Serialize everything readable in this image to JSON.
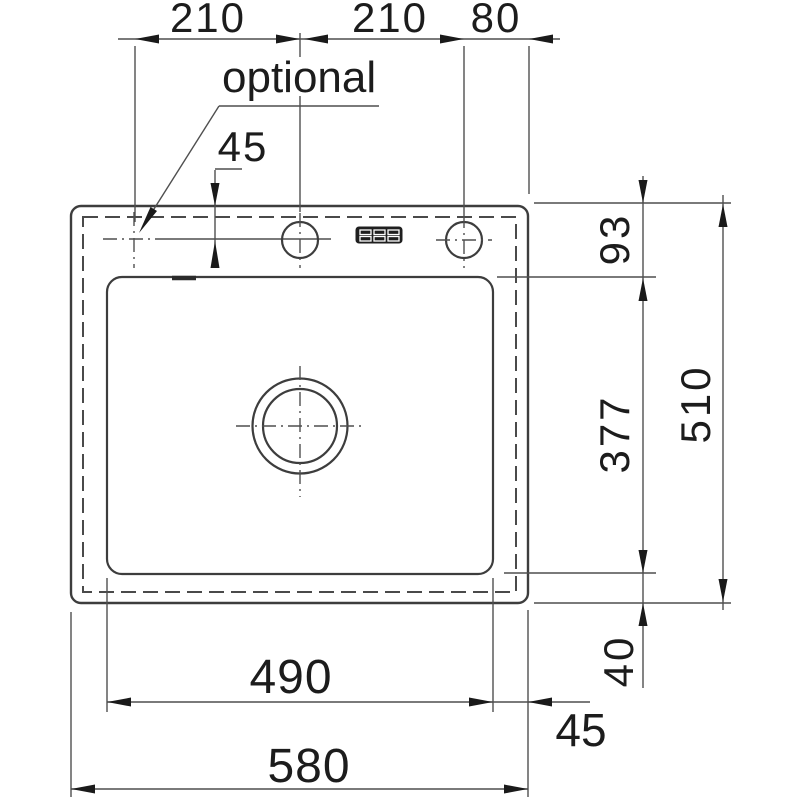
{
  "drawing": {
    "type": "technical-dimension-drawing",
    "subject": "kitchen sink top view with mounting dimensions",
    "units": "mm",
    "colors": {
      "background": "#ffffff",
      "outline": "#3d3d3d",
      "dimension_lines": "#4f4f4f",
      "text": "#1c1c1c"
    },
    "note": {
      "optional_label": "optional"
    },
    "labels": {
      "top_left_210": "210",
      "top_center_210": "210",
      "top_right_80": "80",
      "hole_offset_45": "45",
      "right_93": "93",
      "right_377": "377",
      "right_510": "510",
      "right_40": "40",
      "bottom_490": "490",
      "bottom_580": "580",
      "bottom_right_45": "45"
    },
    "dimensions": [
      {
        "value": 210,
        "orientation": "horizontal",
        "from": "optional hole center",
        "to": "center tap hole"
      },
      {
        "value": 210,
        "orientation": "horizontal",
        "from": "center tap hole",
        "to": "right tap hole"
      },
      {
        "value": 80,
        "orientation": "horizontal",
        "from": "right tap hole",
        "to": "right outer edge"
      },
      {
        "value": 45,
        "orientation": "vertical",
        "from": "top outer edge",
        "to": "tap hole centerline"
      },
      {
        "value": 93,
        "orientation": "vertical",
        "from": "top outer edge",
        "to": "bowl top edge"
      },
      {
        "value": 377,
        "orientation": "vertical",
        "from": "bowl top edge",
        "to": "bowl bottom edge"
      },
      {
        "value": 510,
        "orientation": "vertical",
        "from": "top outer edge",
        "to": "bottom outer edge"
      },
      {
        "value": 40,
        "orientation": "vertical",
        "from": "bowl bottom edge",
        "to": "bottom outer edge"
      },
      {
        "value": 490,
        "orientation": "horizontal",
        "from": "bowl left edge",
        "to": "bowl right edge"
      },
      {
        "value": 580,
        "orientation": "horizontal",
        "from": "left outer edge",
        "to": "right outer edge"
      },
      {
        "value": 45,
        "orientation": "horizontal",
        "from": "bowl right edge",
        "to": "right outer edge"
      }
    ]
  }
}
